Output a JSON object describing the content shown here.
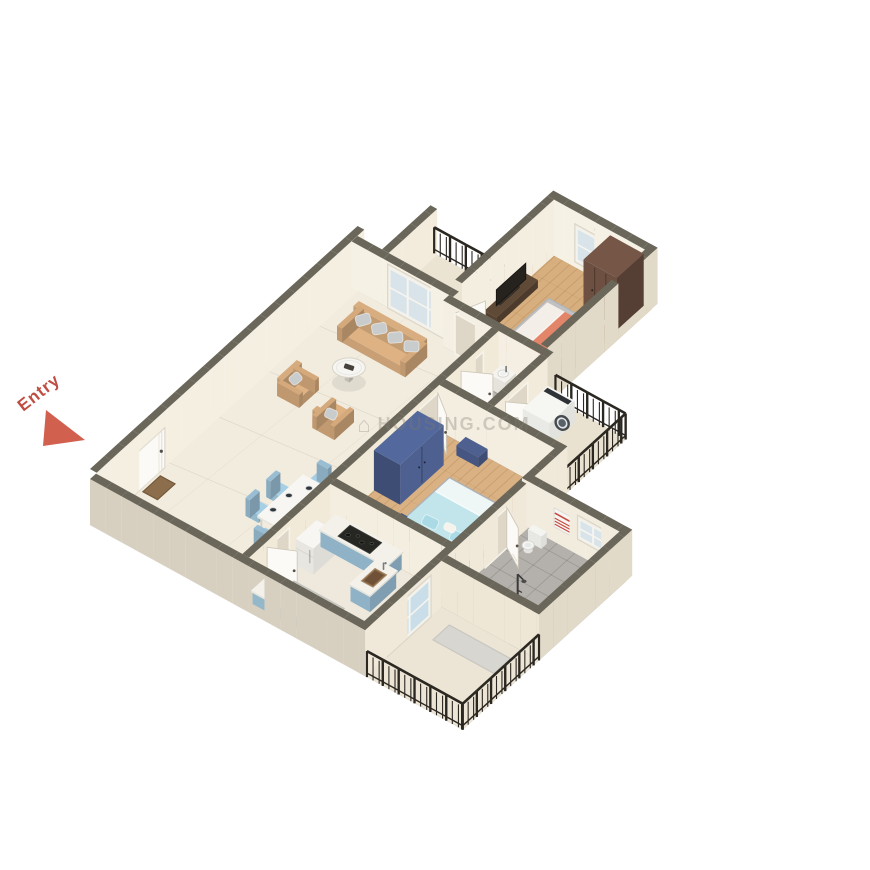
{
  "page": {
    "background": "#ffffff"
  },
  "entry_marker": {
    "label": "Entry",
    "text_color": "#bf4e42",
    "arrow_color": "#d2604e"
  },
  "watermark": {
    "text": "HOUSING.COM",
    "color": "#7f7a6f",
    "opacity": 0.32
  },
  "scene": {
    "iso": {
      "origin": [
        90,
        525
      ],
      "e": [
        12.2,
        6.7
      ],
      "n": [
        10.9,
        -9.9
      ],
      "depth": [
        0.66,
        -0.75
      ]
    },
    "heights": {
      "wall": 46,
      "tall": 56,
      "door": 40,
      "railing": 26
    },
    "colors": {
      "wallTop": "#6a675a",
      "doorFace": "#fbfaf6",
      "opening": "#ded6c6",
      "frame": "#f2efe6",
      "glass": "#d8e4ea",
      "glassSlider": "#c9dee9",
      "railing": "#2b2721"
    },
    "floors": [
      {
        "id": "floor-living",
        "room": "Living / Dining",
        "x1": 0,
        "y1": 0,
        "x2": 12.55,
        "y2": 24,
        "fill": "#f2ecdf",
        "pattern": "marble"
      },
      {
        "id": "floor-kitchen",
        "room": "Kitchen",
        "x1": 12,
        "y1": 0,
        "x2": 22.55,
        "y2": 8,
        "fill": "#eee9dc",
        "pattern": "plain"
      },
      {
        "id": "floor-bedroom2",
        "room": "Bedroom 2",
        "x1": 12,
        "y1": 8,
        "x2": 22.55,
        "y2": 18,
        "fill": "#d9b183",
        "pattern": "wood"
      },
      {
        "id": "floor-bath1",
        "room": "Bathroom 1",
        "x1": 12,
        "y1": 18,
        "x2": 16.55,
        "y2": 24,
        "fill": "#b7b4af",
        "pattern": "tile"
      },
      {
        "id": "floor-service-balcony",
        "room": "Service Balcony",
        "x1": 16,
        "y1": 18,
        "x2": 22.55,
        "y2": 24,
        "fill": "#eae2d1",
        "pattern": "plain"
      },
      {
        "id": "floor-bedroom1",
        "room": "Bedroom 1",
        "x1": 8,
        "y1": 23.45,
        "x2": 16.55,
        "y2": 33,
        "fill": "#d7ae7d",
        "pattern": "wood"
      },
      {
        "id": "floor-balcony-top",
        "room": "Balcony",
        "x1": 2,
        "y1": 24,
        "x2": 8.3,
        "y2": 29,
        "fill": "#ece4d2",
        "pattern": "plain"
      },
      {
        "id": "floor-bath2",
        "room": "Bathroom 2",
        "x1": 22,
        "y1": 7,
        "x2": 30.55,
        "y2": 15,
        "fill": "#b4b1ac",
        "pattern": "tile"
      },
      {
        "id": "floor-balcony-bottom",
        "room": "Balcony",
        "x1": 22,
        "y1": 0,
        "x2": 30.55,
        "y2": 7,
        "fill": "#ece5d6",
        "pattern": "plain"
      }
    ],
    "walls": [
      {
        "id": "wall-west",
        "axis": "ns",
        "x": 0.55,
        "y1": 0,
        "y2": 24.55,
        "h": "tall",
        "face": "#f5efe2"
      },
      {
        "id": "wall-south",
        "axis": "ew",
        "y": 0,
        "x1": 0,
        "x2": 22.55,
        "h": "wall",
        "face": "#d7d0c1"
      },
      {
        "id": "wall-living-north",
        "axis": "ew",
        "y": 24,
        "x1": 0,
        "x2": 8.3,
        "h": "wall",
        "face": "#f6f1e5"
      },
      {
        "id": "wall-balcony-top-west",
        "axis": "ns",
        "x": 2.55,
        "y1": 24.55,
        "y2": 29,
        "h": "wall",
        "face": "#f3ecdd"
      },
      {
        "id": "wall-bedroom1-west",
        "axis": "ns",
        "x": 8.55,
        "y1": 24.55,
        "y2": 33,
        "h": "tall",
        "face": "#f4eee0"
      },
      {
        "id": "wall-bedroom1-north",
        "axis": "ew",
        "y": 33,
        "x1": 8,
        "x2": 16.55,
        "h": "tall",
        "face": "#f6f1e5"
      },
      {
        "id": "wall-bedroom1-east",
        "axis": "ns",
        "x": 16.55,
        "y1": 23.45,
        "y2": 33.55,
        "h": "tall",
        "face": "#e2dac8"
      },
      {
        "id": "wall-bedroom1-south",
        "axis": "ew",
        "y": 23.45,
        "x1": 8,
        "x2": 16.55,
        "h": "wall",
        "face": "#f4efe2"
      },
      {
        "id": "wall-central",
        "axis": "ns",
        "x": 12.55,
        "y1": 0.55,
        "y2": 23.45,
        "h": "wall",
        "face": "#f1ead9"
      },
      {
        "id": "wall-kitchen-north",
        "axis": "ew",
        "y": 8,
        "x1": 12.55,
        "x2": 22.55,
        "h": "wall",
        "face": "#f4eee1"
      },
      {
        "id": "wall-bedroom2-east",
        "axis": "ns",
        "x": 22.55,
        "y1": 7,
        "y2": 18.55,
        "h": "wall",
        "face": "#f0e9da"
      },
      {
        "id": "wall-bedroom2-north",
        "axis": "ew",
        "y": 18,
        "x1": 12.55,
        "x2": 22.55,
        "h": "wall",
        "face": "#f4eee1"
      },
      {
        "id": "wall-bath2-north",
        "axis": "ew",
        "y": 15,
        "x1": 22,
        "x2": 30.55,
        "h": "wall",
        "face": "#f2ecdf"
      },
      {
        "id": "wall-bath2-east",
        "axis": "ns",
        "x": 30.55,
        "y1": 7,
        "y2": 15.55,
        "h": "wall",
        "face": "#e2dac8"
      },
      {
        "id": "wall-balcony-bottom-north",
        "axis": "ew",
        "y": 7,
        "x1": 22.55,
        "x2": 30.55,
        "h": "wall",
        "face": "#eee7d6"
      },
      {
        "id": "wall-kitchen-balcony",
        "axis": "ns",
        "x": 22.55,
        "y1": 0,
        "y2": 7,
        "h": "wall",
        "face": "#f0e9da"
      },
      {
        "id": "wall-bath1-east",
        "axis": "ns",
        "x": 16.55,
        "y1": 18.55,
        "y2": 23.45,
        "h": "wall",
        "face": "#f2ebdc"
      }
    ],
    "doors": [
      {
        "id": "door-entry",
        "wall": "ns",
        "x": 0.55,
        "y1": 3.2,
        "y2": 6.2
      },
      {
        "id": "door-kitchen",
        "wall": "ns",
        "x": 12.55,
        "y1": 2.2,
        "y2": 4.2,
        "leaf": {
          "hx": 12.55,
          "hy": 2.2,
          "fx": 14.3,
          "fy": 3.0
        }
      },
      {
        "id": "door-bedroom2",
        "wall": "ns",
        "x": 12.55,
        "y1": 16.0,
        "y2": 17.9,
        "leaf": {
          "hx": 12.55,
          "hy": 17.85,
          "fx": 14.25,
          "fy": 16.75
        }
      },
      {
        "id": "door-bath1",
        "wall": "ns",
        "x": 12.55,
        "y1": 20.0,
        "y2": 22.0,
        "leaf": {
          "hx": 12.55,
          "hy": 20.0,
          "fx": 14.35,
          "fy": 20.9
        }
      },
      {
        "id": "door-bath2",
        "wall": "ns",
        "x": 22.55,
        "y1": 11.0,
        "y2": 13.0,
        "leaf": {
          "hx": 22.55,
          "hy": 13.0,
          "fx": 24.3,
          "fy": 12.1
        }
      },
      {
        "id": "door-service",
        "wall": "ns",
        "x": 16.55,
        "y1": 19.6,
        "y2": 21.6,
        "leaf": {
          "hx": 16.55,
          "hy": 19.6,
          "fx": 18.3,
          "fy": 20.5
        }
      },
      {
        "id": "door-bedroom1",
        "wall": "ew",
        "y": 23.45,
        "x1": 9.0,
        "x2": 11.0,
        "leaf": {
          "hx": 9.0,
          "hy": 23.45,
          "fx": 9.85,
          "fy": 25.25
        }
      }
    ],
    "windows": [
      {
        "id": "window-living-balcony",
        "wall": "ew",
        "y": 24,
        "x1": 3.0,
        "x2": 8.0,
        "sill": 0,
        "top": 44,
        "panes": 3
      },
      {
        "id": "window-bedroom1",
        "wall": "ew",
        "y": 33,
        "x1": 10.3,
        "x2": 13.7,
        "sill": 6,
        "top": 44,
        "panes": 2
      },
      {
        "id": "window-bath2",
        "wall": "ew",
        "y": 15,
        "x1": 26.6,
        "x2": 29.2,
        "sill": 16,
        "top": 40,
        "panes": 2
      },
      {
        "id": "door-balcony-slider",
        "wall": "ns",
        "x": 22.55,
        "y1": 2.0,
        "y2": 6.0,
        "sill": 0,
        "top": 42,
        "panes": 2,
        "slider": true
      }
    ],
    "railings": [
      {
        "id": "railing-balcony-top",
        "axis": "ew",
        "y": 29,
        "x1": 2.3,
        "x2": 8.3,
        "base": 0
      },
      {
        "id": "railing-bedroom1-window",
        "axis": "ew",
        "y": 33.9,
        "x1": 10.0,
        "x2": 14.0,
        "base": 8
      },
      {
        "id": "railing-service-east",
        "axis": "ns",
        "x": 22.55,
        "y1": 18.3,
        "y2": 23.9,
        "base": 0
      },
      {
        "id": "railing-service-north",
        "axis": "ew",
        "y": 23.9,
        "x1": 16.8,
        "x2": 22.55,
        "base": 0
      },
      {
        "id": "railing-balcony-bottom-south",
        "axis": "ew",
        "y": 0,
        "x1": 22.7,
        "x2": 30.55,
        "base": 0
      },
      {
        "id": "railing-balcony-bottom-east",
        "axis": "ns",
        "x": 30.55,
        "y1": 0,
        "y2": 7,
        "base": 0
      }
    ],
    "furniture": [
      {
        "id": "sofa",
        "type": "sofa",
        "x1": 2.2,
        "y1": 20.2,
        "x2": 7.8,
        "y2": 22.2,
        "fill": "#dfb283",
        "cushion": "#c9cccd"
      },
      {
        "id": "armchair-1",
        "type": "armchair",
        "x1": 2.3,
        "y1": 14.6,
        "x2": 4.1,
        "y2": 16.4,
        "facing": "e",
        "fill": "#dfb283",
        "cushion": "#c9cccd"
      },
      {
        "id": "armchair-2",
        "type": "armchair",
        "x1": 5.9,
        "y1": 13.8,
        "x2": 7.7,
        "y2": 15.6,
        "facing": "n",
        "fill": "#dfb283",
        "cushion": "#c9cccd"
      },
      {
        "id": "coffee-table",
        "type": "round_table",
        "cx": 5.05,
        "cy": 18.1,
        "r": 1.35,
        "fill": "#f6f5f1"
      },
      {
        "id": "doormat-entry",
        "type": "mat",
        "x1": 0.85,
        "y1": 3.9,
        "x2": 2.05,
        "y2": 5.5,
        "fill": "#8d6e4c",
        "border": "#73583a"
      },
      {
        "id": "dining-table",
        "type": "dining_table",
        "x1": 8.7,
        "y1": 5.6,
        "x2": 10.9,
        "y2": 9.8,
        "fill": "#f7f6f2",
        "plates": [
          [
            9.2,
            6.5
          ],
          [
            9.2,
            7.95
          ],
          [
            10.4,
            6.8
          ],
          [
            10.4,
            8.25
          ],
          [
            9.82,
            9.1
          ]
        ]
      },
      {
        "id": "dining-chair-1",
        "type": "chair",
        "cx": 8.05,
        "cy": 6.4,
        "facing": "e",
        "fill": "#a6cfe5"
      },
      {
        "id": "dining-chair-2",
        "type": "chair",
        "cx": 8.05,
        "cy": 8.3,
        "facing": "e",
        "fill": "#a6cfe5"
      },
      {
        "id": "dining-chair-3",
        "type": "chair",
        "cx": 11.45,
        "cy": 6.7,
        "facing": "w",
        "fill": "#a6cfe5"
      },
      {
        "id": "dining-chair-4",
        "type": "chair",
        "cx": 11.45,
        "cy": 8.6,
        "facing": "w",
        "fill": "#a6cfe5"
      },
      {
        "id": "dining-chair-5",
        "type": "chair",
        "cx": 9.55,
        "cy": 10.35,
        "facing": "s",
        "fill": "#a6cfe5"
      },
      {
        "id": "dining-chair-6",
        "type": "chair",
        "cx": 10.0,
        "cy": 4.95,
        "facing": "n",
        "fill": "#a6cfe5"
      },
      {
        "id": "kitchen-counter",
        "type": "counter",
        "x1": 13.0,
        "y1": 6.6,
        "x2": 18.4,
        "y2": 8.0,
        "h": 16,
        "fill": "#9fc6dd",
        "dz": 3,
        "cooktop": {
          "x1": 14.3,
          "y1": 6.75,
          "x2": 16.9,
          "y2": 7.85
        }
      },
      {
        "id": "kitchen-sink-counter",
        "type": "counter",
        "x1": 17.6,
        "y1": 4.2,
        "x2": 19.2,
        "y2": 6.6,
        "h": 16,
        "fill": "#9fc6dd",
        "sink": {
          "x1": 18.0,
          "y1": 4.75,
          "x2": 18.95,
          "y2": 6.0
        }
      },
      {
        "id": "fridge",
        "type": "fridge",
        "x1": 12.75,
        "y1": 4.6,
        "x2": 14.2,
        "y2": 6.5,
        "h": 26,
        "fill": "#f2f1ed",
        "dz": 2
      },
      {
        "id": "kitchen-low-counter",
        "type": "counter",
        "x1": 12.75,
        "y1": 0.65,
        "x2": 16.9,
        "y2": 1.9,
        "h": 12,
        "fill": "#a6cbe0"
      },
      {
        "id": "kitchen-mat",
        "type": "mat",
        "x1": 13.6,
        "y1": 2.3,
        "x2": 17.7,
        "y2": 3.5,
        "fill": "#d6d5d1",
        "border": "#c2c1bd"
      },
      {
        "id": "bedroom2-rug",
        "type": "mat",
        "x1": 15.7,
        "y1": 9.3,
        "x2": 21.95,
        "y2": 15.4,
        "fill": "#bcbfc1",
        "border": "#aeb1b3"
      },
      {
        "id": "bedroom2-bed",
        "type": "bed",
        "head": "s",
        "x1": 16.3,
        "y1": 10.0,
        "x2": 22.0,
        "y2": 14.7,
        "frame": "#4d6090",
        "mattress": "#c1e5eb",
        "sheet": "#eef6f6",
        "pillow": "#a9dae6",
        "headboard": "#45578a"
      },
      {
        "id": "bedroom2-wardrobe",
        "type": "wardrobe",
        "x1": 12.55,
        "y1": 12.0,
        "x2": 14.7,
        "y2": 16.0,
        "h": 40,
        "fill": "#4d6090",
        "front": "e",
        "dz": 5
      },
      {
        "id": "bedroom2-bench",
        "type": "bench",
        "x1": 14.8,
        "y1": 17.05,
        "x2": 16.6,
        "y2": 17.9,
        "h": 10,
        "fill": "#4d6090",
        "dz": 2
      },
      {
        "id": "bedroom2-nightstand",
        "type": "nightstand",
        "x1": 21.25,
        "y1": 8.65,
        "x2": 22.0,
        "y2": 9.45,
        "h": 10,
        "fill": "#45578a",
        "lamp": true
      },
      {
        "id": "bedroom1-rug",
        "type": "mat",
        "x1": 10.7,
        "y1": 24.7,
        "x2": 16.0,
        "y2": 30.1,
        "fill": "#bfc1c3",
        "border": "#b1b3b5"
      },
      {
        "id": "bedroom1-bed",
        "type": "bed",
        "head": "e",
        "x1": 11.4,
        "y1": 25.4,
        "x2": 16.0,
        "y2": 29.2,
        "frame": "#df8165",
        "mattress": "#e28569",
        "sheet": "#f3efe8",
        "pillow": "#ec9a82",
        "headboard": "#d2725a"
      },
      {
        "id": "bedroom1-wardrobe",
        "type": "wardrobe",
        "x1": 13.2,
        "y1": 30.5,
        "x2": 15.95,
        "y2": 32.95,
        "h": 52,
        "fill": "#6d5041",
        "front": "s",
        "dz": 2
      },
      {
        "id": "bedroom1-nightstand-south",
        "type": "nightstand",
        "x1": 15.3,
        "y1": 24.15,
        "x2": 16.0,
        "y2": 24.95,
        "h": 10,
        "fill": "#f0ede5",
        "lamp": true
      },
      {
        "id": "bedroom1-nightstand-north",
        "type": "nightstand",
        "x1": 15.3,
        "y1": 29.55,
        "x2": 16.0,
        "y2": 30.35,
        "h": 10,
        "fill": "#f0ede5",
        "lamp": false
      },
      {
        "id": "tv-unit",
        "type": "tv_unit",
        "x1": 8.55,
        "y1": 26.6,
        "x2": 9.55,
        "y2": 30.4,
        "fill": "#5f4937",
        "dz": 3
      },
      {
        "id": "washbasin",
        "type": "washbasin",
        "x1": 12.8,
        "y1": 22.4,
        "x2": 14.0,
        "y2": 23.4,
        "h": 14,
        "fill": "#f0eee9"
      },
      {
        "id": "shower-bath1",
        "type": "shower",
        "cx": 13.25,
        "cy": 19.5
      },
      {
        "id": "toilet",
        "type": "toilet",
        "cx": 23.85,
        "cy": 13.55
      },
      {
        "id": "shower-bath2",
        "type": "shower",
        "cx": 26.3,
        "cy": 9.8
      },
      {
        "id": "towel",
        "type": "towel",
        "y": 15,
        "x1": 24.7,
        "x2": 26.1
      },
      {
        "id": "washing-machine",
        "type": "washing_machine",
        "x1": 16.8,
        "y1": 20.9,
        "x2": 19.0,
        "y2": 23.2,
        "h": 22,
        "fill": "#f4f4f1",
        "dz": 3
      },
      {
        "id": "balcony-mat",
        "type": "mat",
        "x1": 24.0,
        "y1": 4.6,
        "x2": 29.0,
        "y2": 6.1,
        "fill": "#d8d6d1",
        "border": "#c8c6c1"
      }
    ]
  }
}
